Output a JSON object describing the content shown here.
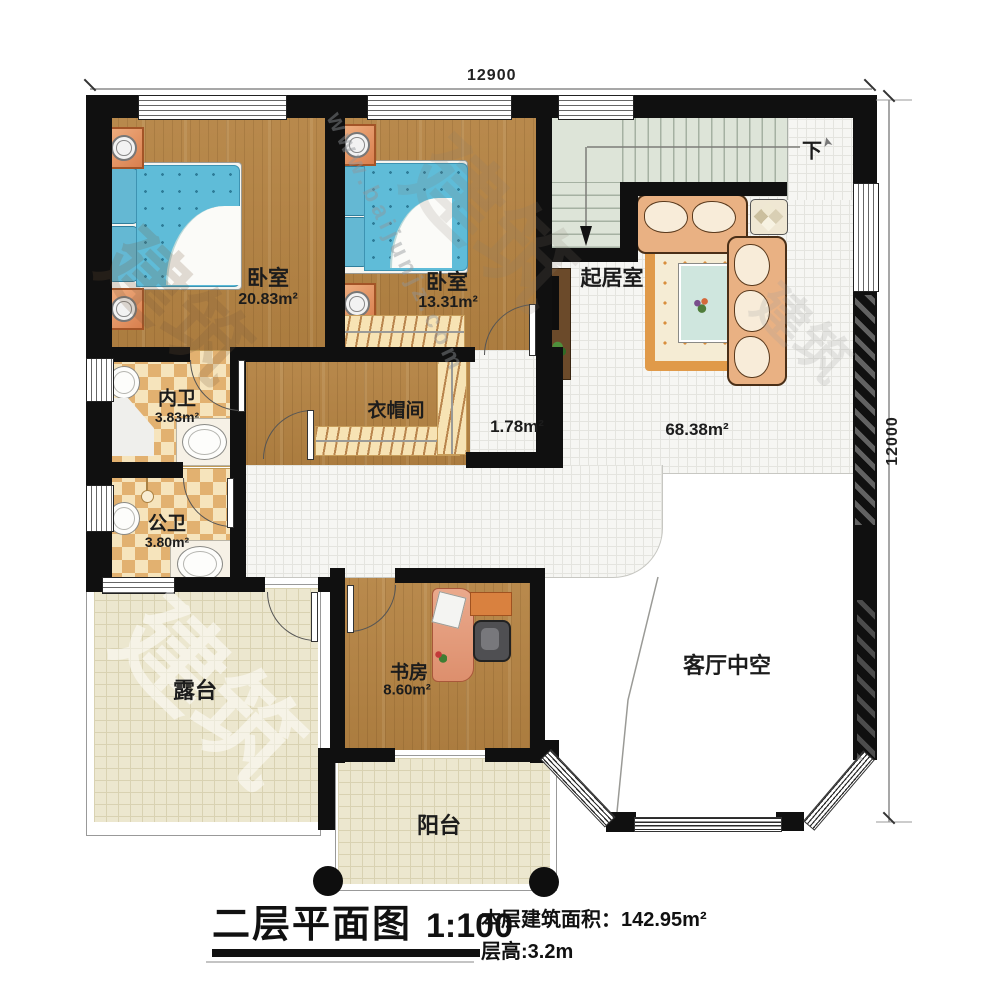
{
  "dimensions": {
    "width_label": "12900",
    "height_label": "12000"
  },
  "rooms": {
    "bedroom1": {
      "name": "卧室",
      "area": "20.83m²"
    },
    "bedroom2": {
      "name": "卧室",
      "area": "13.31m²"
    },
    "living": {
      "name": "起居室",
      "area": "68.38m²"
    },
    "nook": {
      "area": "1.78m²"
    },
    "bath_inner": {
      "name": "内卫",
      "area": "3.83m²"
    },
    "bath_public": {
      "name": "公卫",
      "area": "3.80m²"
    },
    "cloakroom": {
      "name": "衣帽间"
    },
    "study": {
      "name": "书房",
      "area": "8.60m²"
    },
    "terrace": {
      "name": "露台"
    },
    "balcony": {
      "name": "阳台"
    },
    "void": {
      "name": "客厅中空"
    },
    "stairs": {
      "direction_label": "下"
    }
  },
  "caption": {
    "title": "二层平面图",
    "scale": "1:100",
    "floor_area_label": "本层建筑面积：",
    "floor_area_value": "142.95m²",
    "floor_height": "层高:3.2m"
  },
  "watermark": {
    "site": "www.baijunjz.com",
    "logo": "建筑"
  }
}
